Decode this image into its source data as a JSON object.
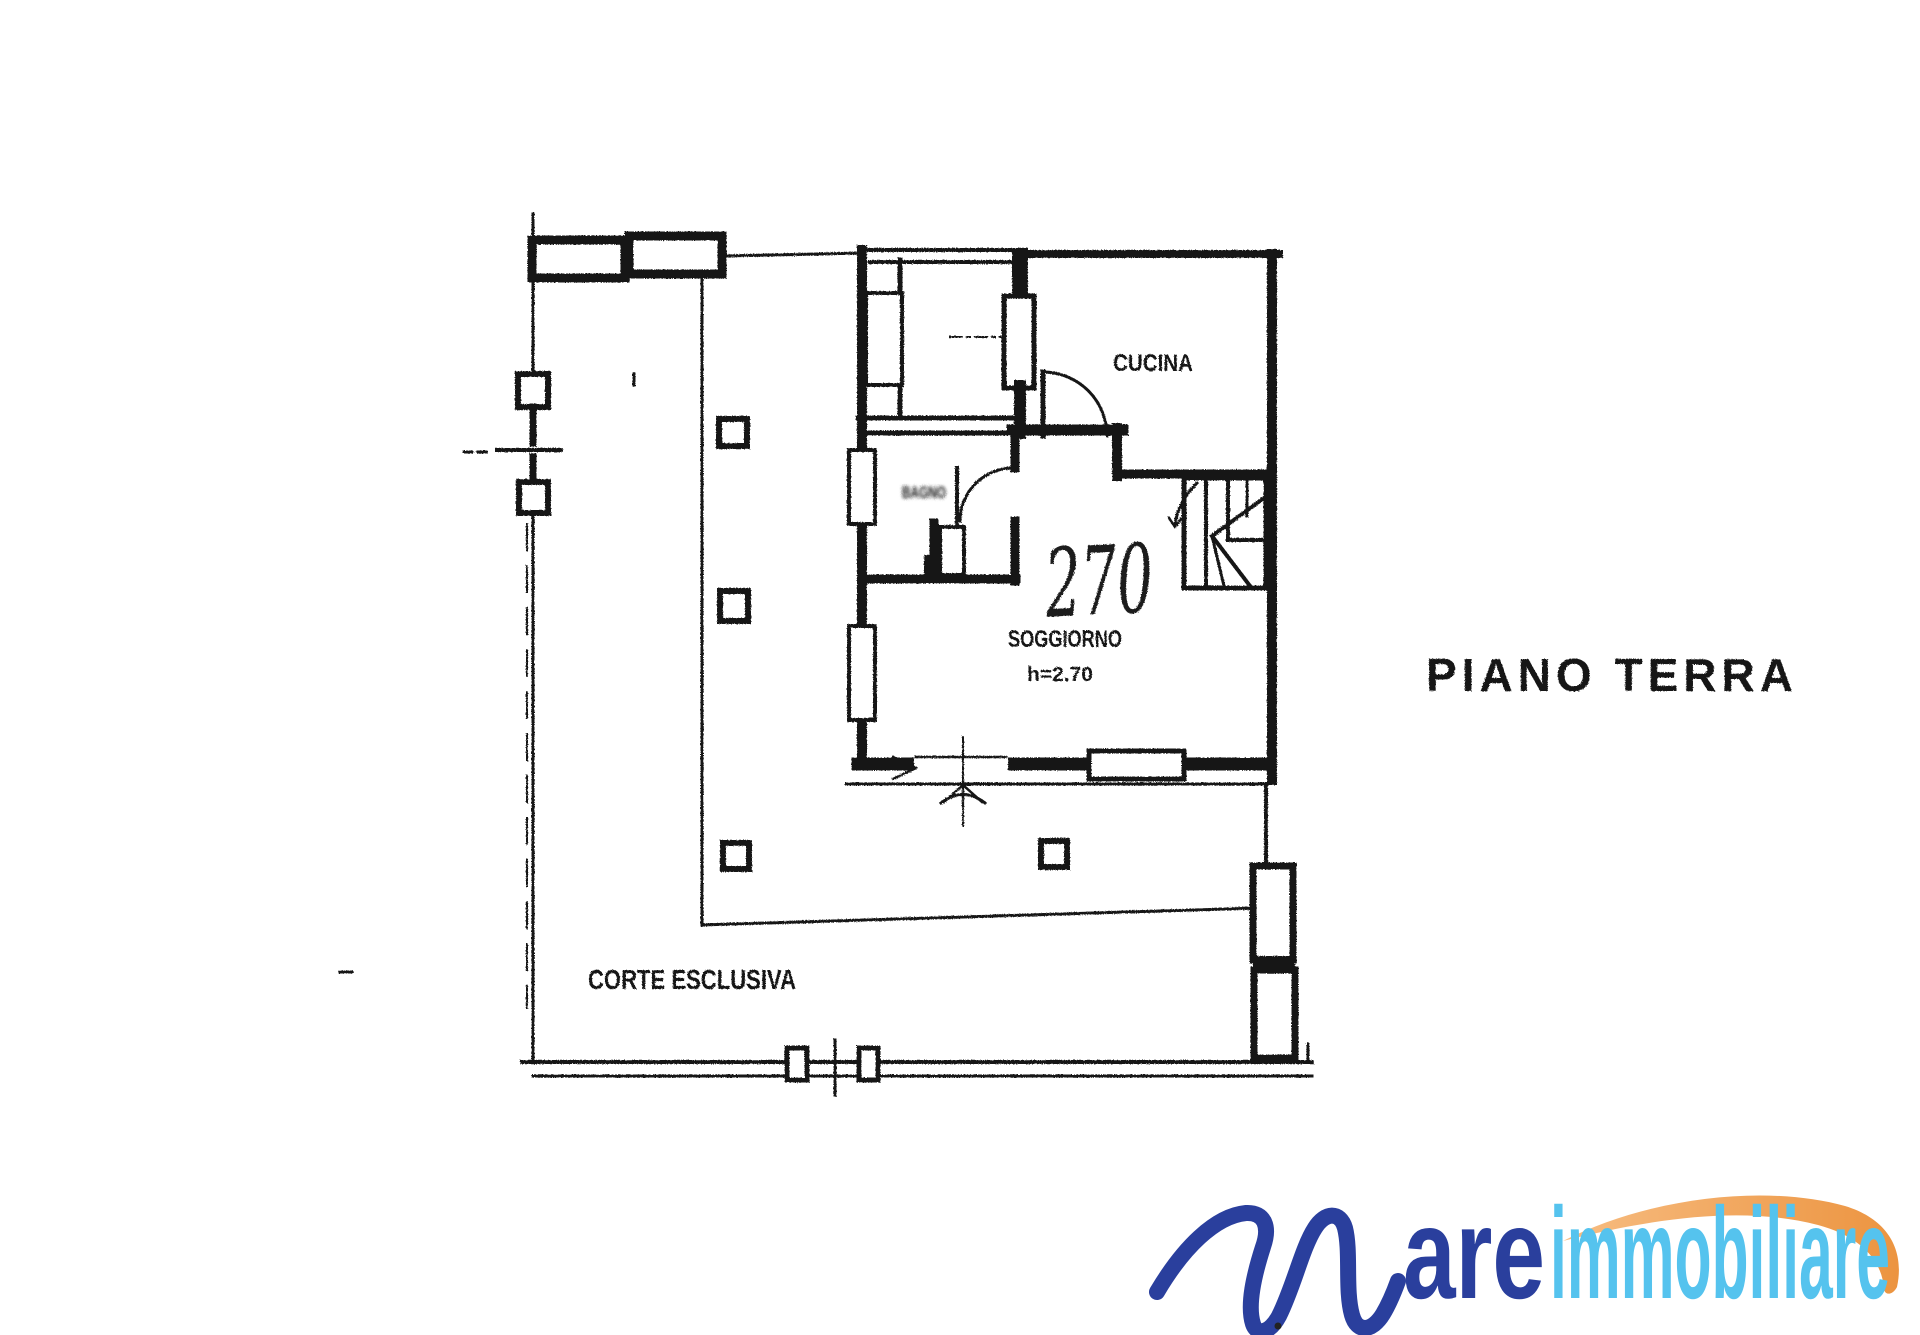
{
  "document": {
    "type": "scanned floor plan",
    "background": "#ffffff",
    "ink_color": "#141414"
  },
  "plan": {
    "floor_label": "PIANO TERRA",
    "rooms": [
      {
        "id": "kitchen",
        "label": "CUCINA"
      },
      {
        "id": "living-room",
        "label": "SOGGIORNO",
        "height_note": "h=2.70"
      },
      {
        "id": "bathroom",
        "label": "BAGNO"
      },
      {
        "id": "courtyard",
        "label": "CORTE ESCLUSIVA"
      }
    ],
    "annotations": {
      "handwritten_number": "270"
    }
  },
  "logo": {
    "letter_m": "M",
    "text_are": "are",
    "text_immobiliare": "immobiliare",
    "colors": {
      "dark_blue": "#2a3f9d",
      "light_blue": "#55c3ee",
      "orange_light": "#f7bd82",
      "orange_dark": "#ec9440"
    }
  }
}
